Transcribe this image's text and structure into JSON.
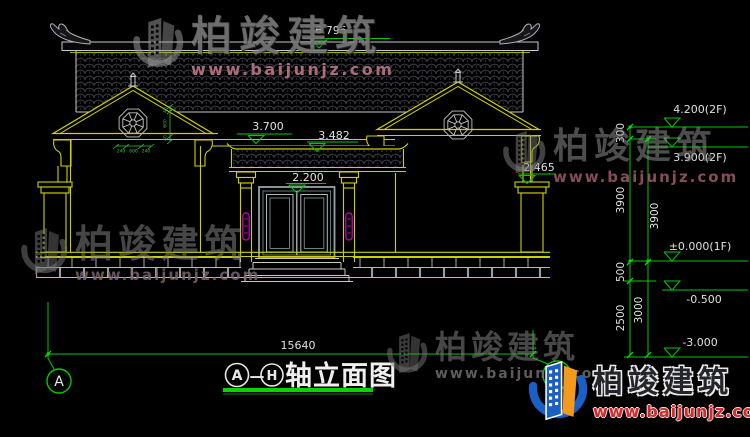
{
  "title_block": {
    "axis_from": "A",
    "dash": "—",
    "axis_to": "H",
    "label": "轴立面图"
  },
  "axis_bubbles": {
    "left": "A",
    "right": "H"
  },
  "elevation_marks": {
    "ridge": "6.795",
    "eave_main": "3.700",
    "canopy_top": "3.482",
    "door_top": "2.200",
    "pier_top": "2.465",
    "right": [
      {
        "label": "4.200(2F)"
      },
      {
        "label": "3.900(2F)"
      },
      {
        "label": "±0.000(1F)"
      },
      {
        "label": "-0.500"
      },
      {
        "label": "-3.000"
      }
    ]
  },
  "dimensions": {
    "overall_width": "15640",
    "right_chain_outer": [
      "300",
      "3900",
      "500",
      "2500"
    ],
    "right_chain_inner": [
      "3900",
      "3000"
    ],
    "window_vertical": [
      "40",
      "600",
      "40"
    ],
    "window_horizontal": [
      "240",
      "600",
      "240"
    ]
  },
  "watermark": {
    "brand": "柏竣建筑",
    "url": "www.baijunjz.com"
  },
  "logo": {
    "brand": "柏竣建筑",
    "url": "www.baijunjz.com"
  },
  "colors": {
    "line_yellow": "#cfcf00",
    "line_white": "#c9c9c9",
    "dim_green": "#00c800",
    "underline_green": "#00d800",
    "magenta": "#d400d4",
    "door_teal": "#8fa6a6",
    "logo_blue": "#1a5fc4",
    "logo_orange": "#f29a1e",
    "logo_red": "#d32a2a"
  }
}
